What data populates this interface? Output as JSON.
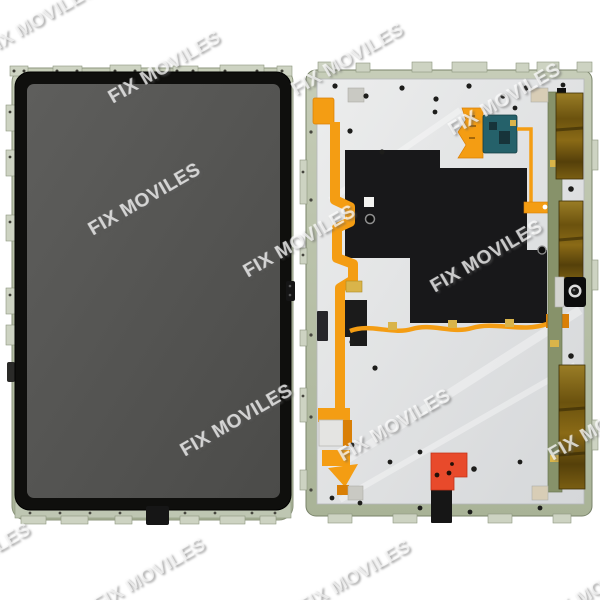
{
  "page": {
    "type": "product-photo",
    "subject": "tablet-display-assembly-front-and-back",
    "background": "#ffffff"
  },
  "watermark": {
    "text": "FIX MOVILES"
  },
  "colors": {
    "screen_gray": "#4b4b49",
    "screen_gray_light": "#5e5e5c",
    "bezel_black": "#0f0f0d",
    "frame_green": "#bac3ad",
    "frame_edge": "#79836a",
    "tab_metal": "#cdd3c2",
    "plate_silver": "#eceded",
    "plate_silver_dark": "#d5d7d9",
    "graphite_black": "#18181a",
    "flex_orange": "#f49d13",
    "flex_orange_dark": "#d97f06",
    "gold_pad": "#d9b44a",
    "pcb_teal": "#25616a",
    "pcb_green": "#87926a",
    "bronze_light": "#9a7d26",
    "bronze_dark": "#55400a",
    "red_connector": "#e84a2b",
    "screw_black": "#1d1d1b",
    "sticker_gray": "#c9c9c3",
    "sticker_tan": "#d8cdb6",
    "connector_black": "#161616",
    "camera_ring": "#dddddd"
  }
}
